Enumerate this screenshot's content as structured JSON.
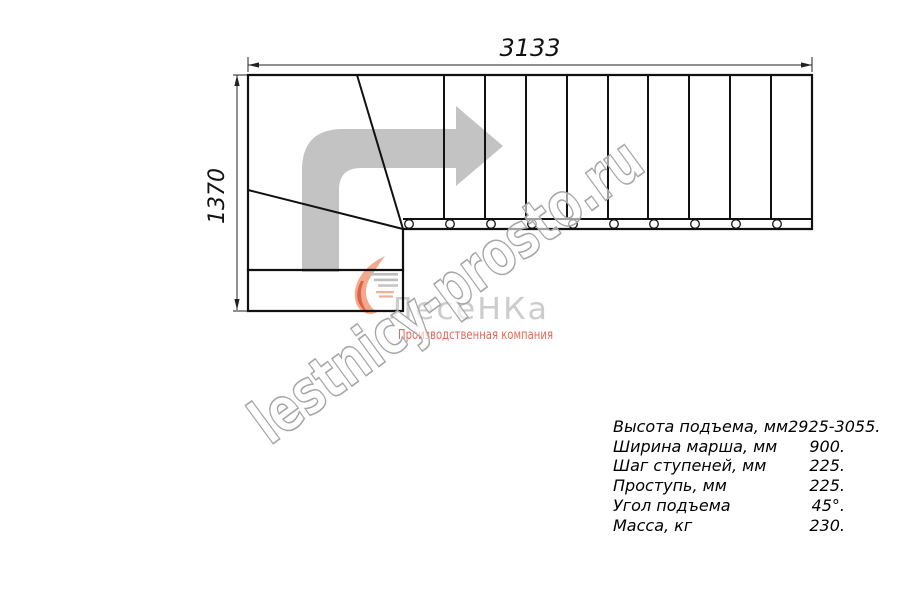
{
  "drawing": {
    "title": "stair plan view, quarter-turn staircase",
    "dim_width_label": "3133",
    "dim_height_label": "1370"
  },
  "watermark": {
    "text": "lestnicy-prosto.ru"
  },
  "logo": {
    "name": "ЛесеНКа",
    "tagline": "Производственная компания"
  },
  "specs": {
    "rows": [
      {
        "label": "Высота подъема, мм",
        "value": "2925-3055."
      },
      {
        "label": "Ширина марша, мм",
        "value": "900."
      },
      {
        "label": "Шаг ступеней, мм",
        "value": "225."
      },
      {
        "label": "Проступь, мм",
        "value": "225."
      },
      {
        "label": "Угол подъема",
        "value": "45°."
      },
      {
        "label": "Масса, кг",
        "value": "230."
      }
    ]
  },
  "colors": {
    "line": "#111111",
    "arrow_gray": "#c3c3c3",
    "watermark_gray": "#a6a6a6",
    "logo_gray": "#cccccc",
    "logo_accent": "#e3695a",
    "logo_swirl": "#f5a98c"
  }
}
